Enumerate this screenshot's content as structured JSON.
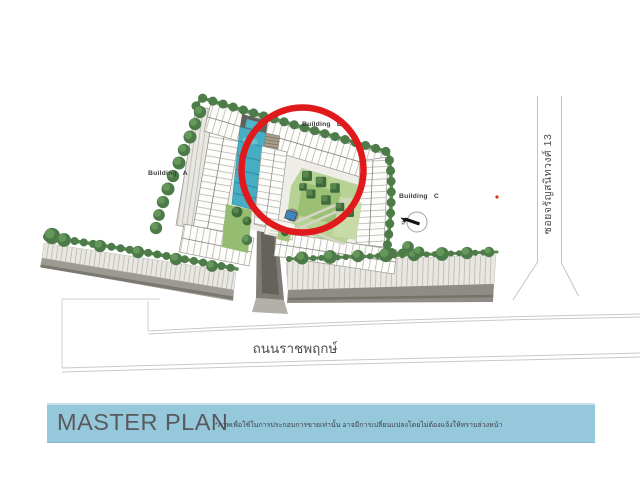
{
  "site_plan": {
    "buildings": [
      {
        "label": "Building A"
      },
      {
        "label": "Building B"
      },
      {
        "label": "Building C"
      }
    ],
    "roads": {
      "bottom_label": "ถนนราชพฤกษ์",
      "right_label": "ซอยจรัญสนิทวงศ์ 13"
    },
    "compass_label": "N",
    "annotation_circle": {
      "color": "#e0191d"
    }
  },
  "palette": {
    "banner_bg": "#96c8dc",
    "pool": "#47adc2",
    "lawn": "#b6d294",
    "tree": "#4d7c49",
    "red": "#e0191d"
  },
  "footer": {
    "title": "MASTER PLAN",
    "disclaimer": "*ภาพเพื่อใช้ในการประกอบการขายเท่านั้น อาจมีการเปลี่ยนแปลงโดยไม่ต้องแจ้งให้ทราบล่วงหน้า"
  }
}
